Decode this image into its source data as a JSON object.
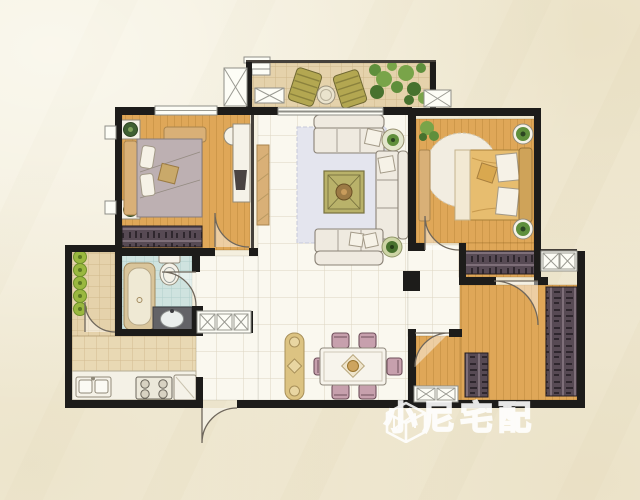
{
  "watermark": {
    "text": "小尼宅配",
    "logo": "isometric-cube-logo"
  },
  "palette": {
    "paper": "#f2ecd9",
    "wall": "#1d1c1a",
    "wood": "#dfa758",
    "woodLine": "#c08c3e",
    "tileLight": "#faf8ef",
    "tileLightLine": "#d9d2bd",
    "balconyTile": "#e5d2ab",
    "balconyTileLine": "#c8b183",
    "kitchenTile": "#e9d9b4",
    "kitchenTileLine": "#cdb488",
    "bathTile": "#cfe3df",
    "bathTileLine": "#a9cbc5",
    "rug": "#e4e5ee",
    "rugLine": "#c6c9da",
    "sofa": "#efeae0",
    "sofaLine": "#8a8276",
    "olive": "#b9b26a",
    "oliveDark": "#77713e",
    "chairMauve": "#c7a0ad",
    "chairMauveDark": "#6f4f5b",
    "wardrobe": "#574a54",
    "wardrobeLight": "#8b7a85",
    "wardrobeDark": "#2f272e",
    "gold": "#e7bd6f",
    "goldDark": "#a98038",
    "grayBed": "#bdb0b2",
    "tan": "#d9b077",
    "green": "#6c9340",
    "greenLight": "#9ab83f",
    "counter": "#f4f1e6"
  },
  "floorplan": {
    "style": "hand-drawn watercolor apartment floor plan, top-down view, no text labels",
    "rooms": [
      {
        "name": "balcony",
        "floor": "terracotta-tile",
        "items": [
          "lounge-chair",
          "lounge-chair",
          "round-table",
          "storage-box-x",
          "storage-box-x",
          "plants",
          "steps"
        ]
      },
      {
        "name": "bedroom-left",
        "floor": "wood-plank",
        "items": [
          "double-bed",
          "nightstand-plant",
          "nightstand-plant",
          "bench",
          "desk",
          "desk-chair",
          "monitor",
          "wardrobe",
          "window"
        ]
      },
      {
        "name": "living-room",
        "floor": "ceramic-tile",
        "items": [
          "sofa",
          "chaise-sofa",
          "sofa",
          "coffee-table",
          "rug",
          "tv-cabinet",
          "side-table-plant",
          "side-table-plant",
          "balcony-sliding-door"
        ]
      },
      {
        "name": "bedroom-right",
        "floor": "wood-plank",
        "items": [
          "double-bed",
          "round-rug",
          "nightstand-plant",
          "nightstand-plant",
          "bench",
          "wardrobe",
          "corner-plant",
          "window"
        ]
      },
      {
        "name": "bathroom",
        "floor": "blue-tile",
        "items": [
          "bathtub",
          "toilet",
          "vanity-sink"
        ]
      },
      {
        "name": "service-balcony",
        "floor": "tile",
        "items": [
          "potted-plants"
        ]
      },
      {
        "name": "kitchen",
        "floor": "tile",
        "items": [
          "counter",
          "double-sink",
          "cooktop",
          "fridge"
        ]
      },
      {
        "name": "hallway",
        "floor": "ceramic-tile",
        "items": [
          "shoe-cabinet",
          "entry-door"
        ]
      },
      {
        "name": "dining-area",
        "floor": "ceramic-tile",
        "items": [
          "dining-table",
          "dining-chairs-x6",
          "console-table"
        ]
      },
      {
        "name": "room-bottom-right",
        "floor": "wood-plank",
        "items": [
          "wardrobe",
          "cabinet",
          "window-cabinet"
        ]
      }
    ]
  }
}
